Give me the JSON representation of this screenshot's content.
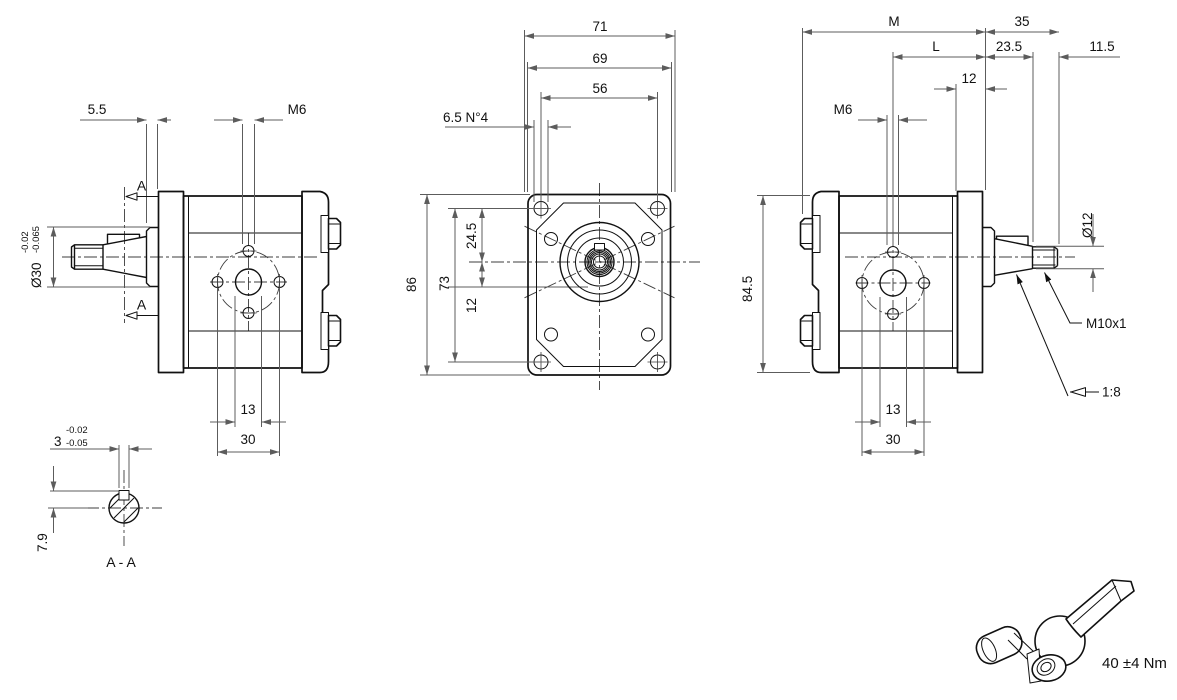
{
  "colors": {
    "line": "#111111",
    "dimension": "#5c5c5c",
    "background": "#ffffff"
  },
  "left_view": {
    "dim_5_5": "5.5",
    "label_m6": "M6",
    "section_top": "A",
    "section_bottom": "A",
    "shaft_dia": "Ø30",
    "tol_upper": "-0.02",
    "tol_lower": "-0.065",
    "dim_13": "13",
    "dim_30": "30"
  },
  "section_aa": {
    "tol_upper": "-0.02",
    "key_width": "3",
    "tol_lower": "-0.05",
    "dim_7_9": "7.9",
    "label": "A - A"
  },
  "front_view": {
    "dim_71": "71",
    "dim_69": "69",
    "dim_56": "56",
    "holes_note": "6.5 N°4",
    "dim_86": "86",
    "dim_73": "73",
    "dim_24_5": "24.5",
    "dim_12": "12"
  },
  "right_view": {
    "dim_M": "M",
    "dim_35": "35",
    "dim_L": "L",
    "dim_23_5": "23.5",
    "dim_11_5": "11.5",
    "dim_12": "12",
    "label_m6": "M6",
    "dim_84_5": "84.5",
    "shaft_dia": "Ø12",
    "thread_label": "M10x1",
    "taper_ratio": "1:8",
    "dim_13": "13",
    "dim_30": "30"
  },
  "torque": {
    "note": "40 ±4 Nm"
  }
}
